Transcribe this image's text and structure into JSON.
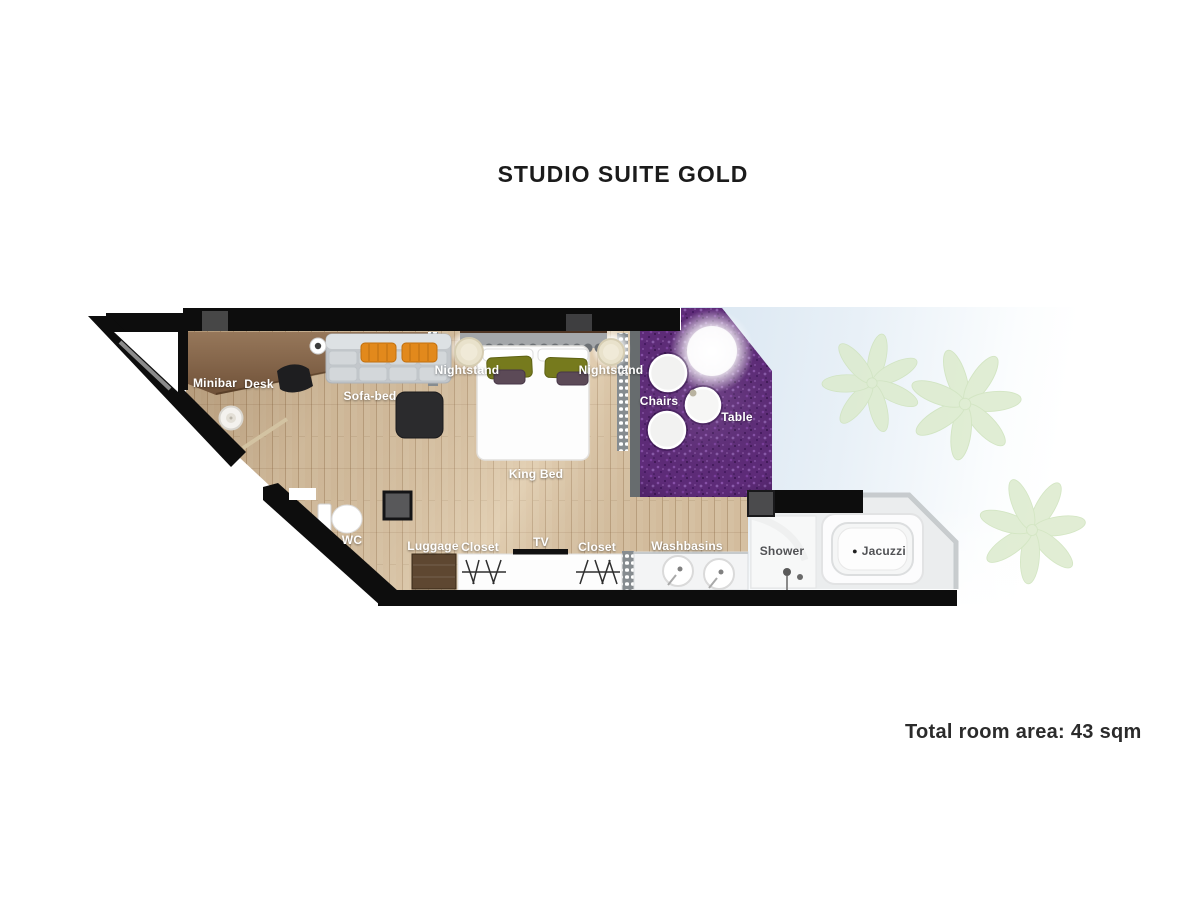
{
  "title": "STUDIO SUITE GOLD",
  "footer": {
    "total_area": "Total room area: 43 sqm"
  },
  "colors": {
    "wall": "#0d0d0d",
    "wood_floor": "#d9c3a4",
    "counter_wood": "#8a6a4b",
    "carpet_purple": "#5e2b79",
    "terrace_blue": "#d9e6f1",
    "plant_green": "#dcebcd",
    "sofa_gray": "#c3c7cb",
    "pillow_orange": "#e2891c",
    "pillow_olive": "#767a1d",
    "cushion_plum": "#5c4a57",
    "bathroom_floor": "#ebedee",
    "label_light": "#ffffff",
    "label_dark": "#525356"
  },
  "plan": {
    "labels": [
      {
        "name": "minibar",
        "text": "Minibar",
        "x": 215,
        "y": 383,
        "theme": "light"
      },
      {
        "name": "desk",
        "text": "Desk",
        "x": 259,
        "y": 384,
        "theme": "light"
      },
      {
        "name": "sofa-bed",
        "text": "Sofa-bed",
        "x": 370,
        "y": 396,
        "theme": "light"
      },
      {
        "name": "nightstand-left",
        "text": "Nightstand",
        "x": 467,
        "y": 370,
        "theme": "light"
      },
      {
        "name": "nightstand-right",
        "text": "Nightstand",
        "x": 611,
        "y": 370,
        "theme": "light"
      },
      {
        "name": "chairs",
        "text": "Chairs",
        "x": 659,
        "y": 401,
        "theme": "light"
      },
      {
        "name": "table",
        "text": "Table",
        "x": 737,
        "y": 417,
        "theme": "light"
      },
      {
        "name": "king-bed",
        "text": "King Bed",
        "x": 536,
        "y": 474,
        "theme": "light"
      },
      {
        "name": "wc",
        "text": "WC",
        "x": 352,
        "y": 540,
        "theme": "light"
      },
      {
        "name": "luggage",
        "text": "Luggage",
        "x": 433,
        "y": 546,
        "theme": "light"
      },
      {
        "name": "closet-left",
        "text": "Closet",
        "x": 480,
        "y": 547,
        "theme": "light"
      },
      {
        "name": "tv",
        "text": "TV",
        "x": 541,
        "y": 542,
        "theme": "light"
      },
      {
        "name": "closet-right",
        "text": "Closet",
        "x": 597,
        "y": 547,
        "theme": "light"
      },
      {
        "name": "washbasins",
        "text": "Washbasins",
        "x": 687,
        "y": 546,
        "theme": "light"
      },
      {
        "name": "shower",
        "text": "Shower",
        "x": 782,
        "y": 551,
        "theme": "dark"
      },
      {
        "name": "jacuzzi",
        "text": "Jacuzzi",
        "x": 879,
        "y": 551,
        "theme": "dark",
        "marker": "dot"
      }
    ]
  }
}
